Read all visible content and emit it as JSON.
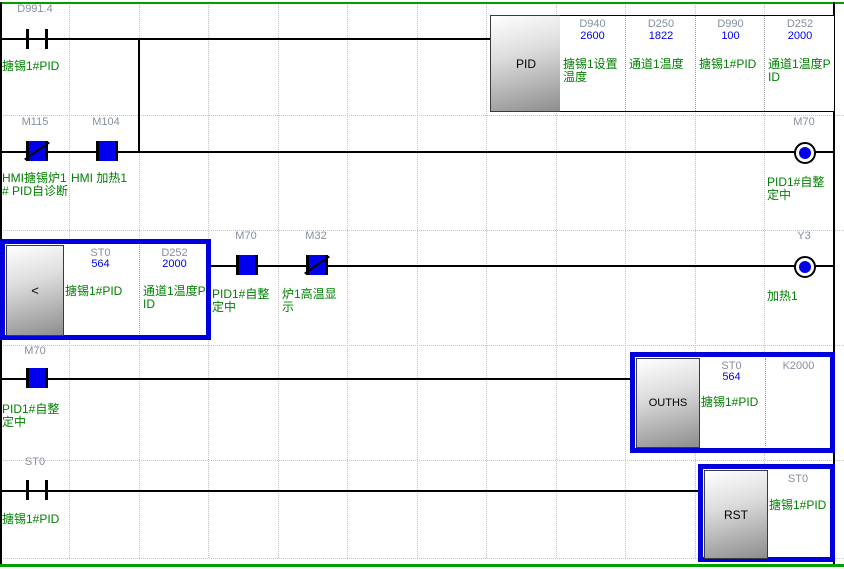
{
  "app": {
    "type": "plc-ladder-monitor-view"
  },
  "colors": {
    "device_text": "#848f9c",
    "value_text": "#0000ee",
    "comment_text": "#008000",
    "energized": "#0000ee",
    "selection_border": "#0000dd",
    "section_separator": "#00a000",
    "wire": "#000000"
  },
  "rungs": [
    {
      "contacts": [
        {
          "device": "D991.4",
          "comment": "搪锡1#PID",
          "kind": "no",
          "state": "off"
        }
      ],
      "instruction": {
        "mnemonic": "PID",
        "selected": false,
        "operands": [
          {
            "device": "D940",
            "value": "2600",
            "comment": "搪锡1设置温度"
          },
          {
            "device": "D250",
            "value": "1822",
            "comment": "通道1温度"
          },
          {
            "device": "D990",
            "value": "100",
            "comment": "搪锡1#PID"
          },
          {
            "device": "D252",
            "value": "2000",
            "comment": "通道1温度PID"
          }
        ]
      }
    },
    {
      "contacts": [
        {
          "device": "M115",
          "comment": "HMI搪锡炉1# PID自诊断",
          "kind": "nc",
          "state": "on"
        },
        {
          "device": "M104",
          "comment": "HMI 加热1",
          "kind": "no",
          "state": "on"
        }
      ],
      "coil": {
        "device": "M70",
        "comment": "PID1#自整定中",
        "state": "on"
      }
    },
    {
      "instruction": {
        "mnemonic": "<",
        "selected": true,
        "operands": [
          {
            "device": "ST0",
            "value": "564",
            "comment": "搪锡1#PID"
          },
          {
            "device": "D252",
            "value": "2000",
            "comment": "通道1温度PID"
          }
        ]
      },
      "contacts": [
        {
          "device": "M70",
          "comment": "PID1#自整定中",
          "kind": "no",
          "state": "on"
        },
        {
          "device": "M32",
          "comment": "炉1高温显示",
          "kind": "nc",
          "state": "on"
        }
      ],
      "coil": {
        "device": "Y3",
        "comment": "加热1",
        "state": "on"
      }
    },
    {
      "contacts": [
        {
          "device": "M70",
          "comment": "PID1#自整定中",
          "kind": "no",
          "state": "on"
        }
      ],
      "instruction": {
        "mnemonic": "OUTHS",
        "selected": true,
        "operands": [
          {
            "device": "ST0",
            "value": "564",
            "comment": "搪锡1#PID"
          },
          {
            "device": "K2000",
            "value": "",
            "comment": ""
          }
        ]
      }
    },
    {
      "contacts": [
        {
          "device": "ST0",
          "comment": "搪锡1#PID",
          "kind": "no",
          "state": "off"
        }
      ],
      "instruction": {
        "mnemonic": "RST",
        "selected": true,
        "operands": [
          {
            "device": "ST0",
            "value": "",
            "comment": "搪锡1#PID"
          }
        ]
      }
    }
  ]
}
